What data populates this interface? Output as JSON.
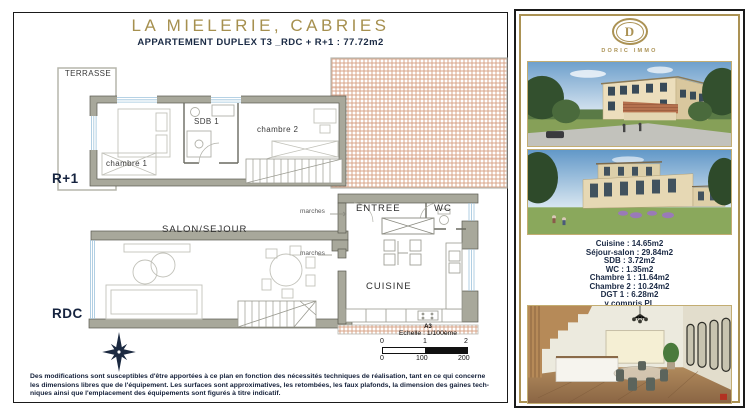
{
  "page": {
    "title": "LA MIELERIE, CABRIES",
    "subtitle_prefix": "APPARTEMENT DUPLEX T3 _RDC + R+1 : ",
    "subtitle_area": "77.72m2"
  },
  "plan": {
    "upper_level": "R+1",
    "ground_level": "RDC",
    "rooms": {
      "terrasse": "TERRASSE",
      "chambre1": "chambre 1",
      "sdb1": "SDB 1",
      "chambre2": "chambre 2",
      "salon": "SALON/SEJOUR",
      "marches_upper": "marches",
      "marches_lower": "marches",
      "entree": "ENTREE",
      "wc": "WC",
      "cuisine": "CUISINE"
    },
    "scale": {
      "sheet": "A3",
      "label": "Echelle : 1/100ème",
      "ticks_m": [
        "0",
        "1",
        "2"
      ],
      "ticks_cm": [
        "0",
        "100",
        "200"
      ]
    }
  },
  "disclaimer": {
    "line1": "Des modifications sont susceptibles d'être apportées à ce plan en fonction  des nécessités techniques de réalisation, tant en ce qui concerne",
    "line2": "les dimensions libres que de l'équipement. Les surfaces sont approximatives, les retombées, les faux plafonds, la dimension des gaines tech-",
    "line3": "niques ainsi que l'emplacement des équipements sont figurés à titre indicatif."
  },
  "sidebar": {
    "brand": {
      "initial": "D",
      "name": "DORIC IMMO"
    },
    "measurements": [
      "Cuisine : 14.65m2",
      "Séjour-salon : 29.84m2",
      "SDB : 3.72m2",
      "WC : 1.35m2",
      "Chambre 1 : 11.64m2",
      "Chambre 2 : 10.24m2",
      "DGT 1 : 6.28m2",
      "y compris PL"
    ]
  },
  "colors": {
    "gold": "#ab9254",
    "navy": "#1b2b45",
    "wall_gray": "#a8a89b",
    "roof_hatch": "#d08d6b"
  }
}
